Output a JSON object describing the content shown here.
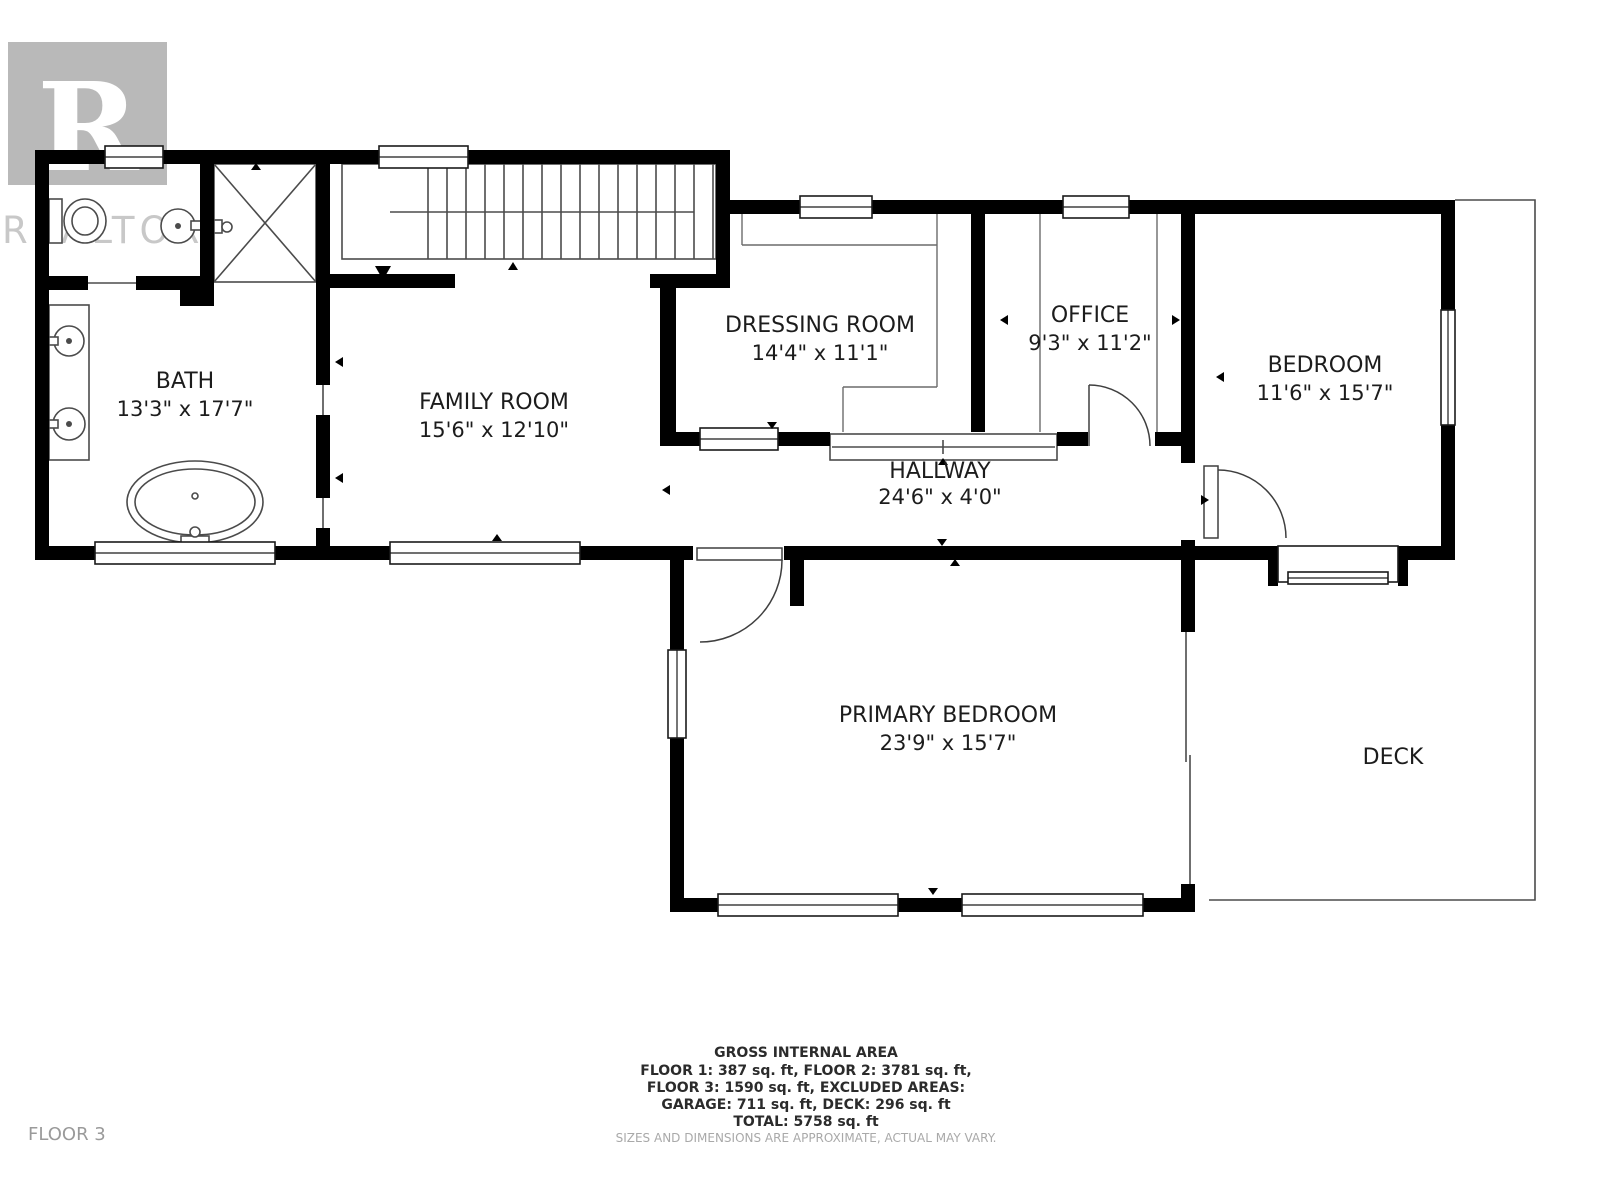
{
  "watermark": {
    "symbol": "R",
    "brand": "REALTOR",
    "reg": "®"
  },
  "rooms": [
    {
      "id": "bath",
      "name": "BATH",
      "dimensions": "13'3\" x 17'7\""
    },
    {
      "id": "family-room",
      "name": "FAMILY ROOM",
      "dimensions": "15'6\" x 12'10\""
    },
    {
      "id": "dressing-room",
      "name": "DRESSING ROOM",
      "dimensions": "14'4\" x 11'1\""
    },
    {
      "id": "office",
      "name": "OFFICE",
      "dimensions": "9'3\" x 11'2\""
    },
    {
      "id": "bedroom",
      "name": "BEDROOM",
      "dimensions": "11'6\" x 15'7\""
    },
    {
      "id": "hallway",
      "name": "HALLWAY",
      "dimensions": "24'6\" x 4'0\""
    },
    {
      "id": "primary-bedroom",
      "name": "PRIMARY BEDROOM",
      "dimensions": "23'9\" x 15'7\""
    },
    {
      "id": "deck",
      "name": "DECK",
      "dimensions": ""
    }
  ],
  "area_summary": {
    "title": "GROSS INTERNAL AREA",
    "line1": "FLOOR 1: 387 sq. ft, FLOOR 2: 3781 sq. ft,",
    "line2": "FLOOR 3: 1590 sq. ft, EXCLUDED AREAS:",
    "line3": "GARAGE: 711 sq. ft, DECK: 296 sq. ft",
    "line4": "TOTAL: 5758 sq. ft"
  },
  "floor_label": "FLOOR 3",
  "disclaimer": "SIZES AND DIMENSIONS ARE APPROXIMATE, ACTUAL MAY VARY.",
  "colors": {
    "wall": "#000000",
    "thin_line": "#4b4b4b",
    "label_text": "#1c1c1c",
    "watermark_gray": "#b9b9b9",
    "watermark_text": "#c8c8c8",
    "footer_text": "#2b2b2b",
    "footer_muted": "#a9a9a9"
  }
}
